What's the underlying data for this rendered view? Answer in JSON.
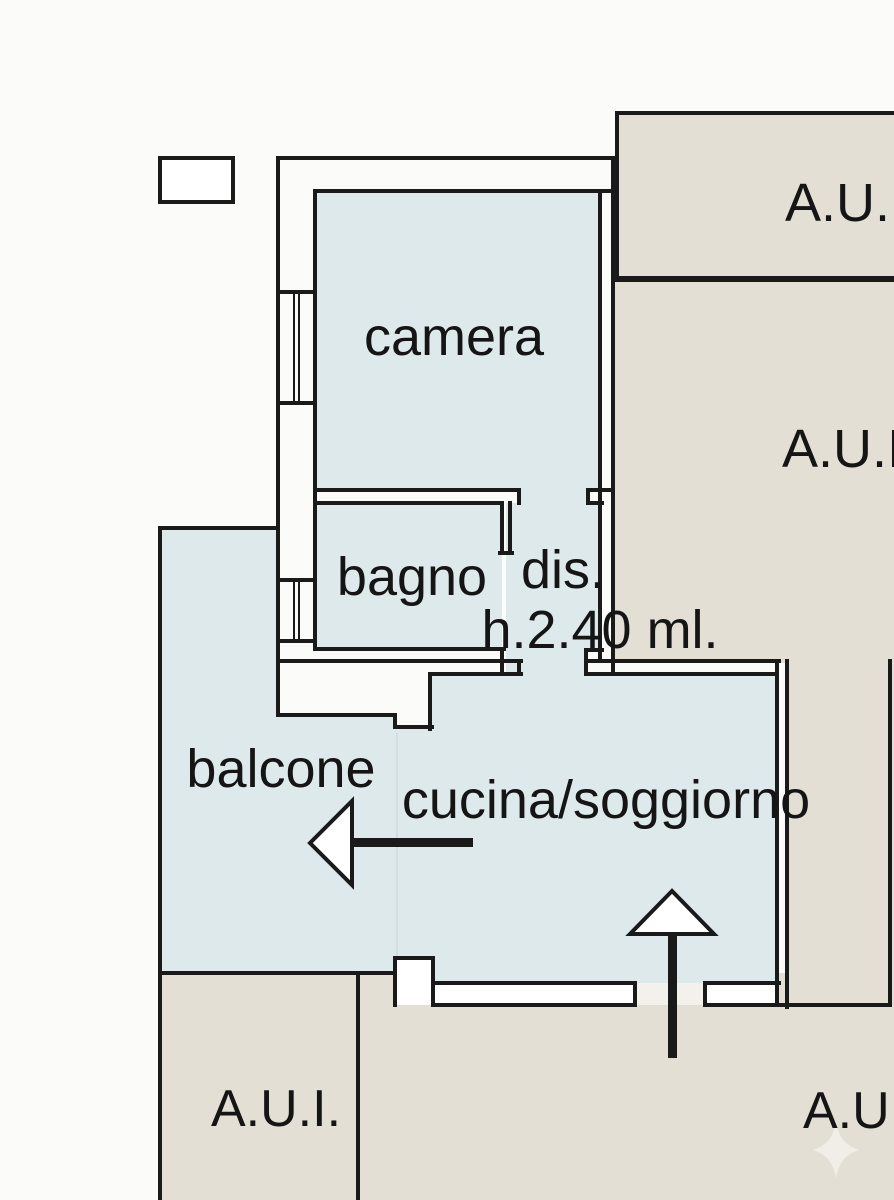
{
  "plan": {
    "rooms": {
      "camera": "camera",
      "bagno": "bagno",
      "dis": "dis.",
      "height_note": "h.2.40 ml.",
      "balcone": "balcone",
      "cucina_soggiorno": "cucina/soggiorno"
    },
    "adjacent_units": {
      "top_right": "A.U.",
      "right": "A.U.I",
      "bottom_left": "A.U.I.",
      "bottom_right": "A.U"
    }
  },
  "colors": {
    "background": "#fbfbfa",
    "floor": "#dee9eb",
    "unit-fill": "#e4dfd4",
    "line": "#1a1a1a",
    "wall-fill": "#ffffff",
    "threshold": "#f3f1ec",
    "sparkle": "#f1eee7"
  }
}
